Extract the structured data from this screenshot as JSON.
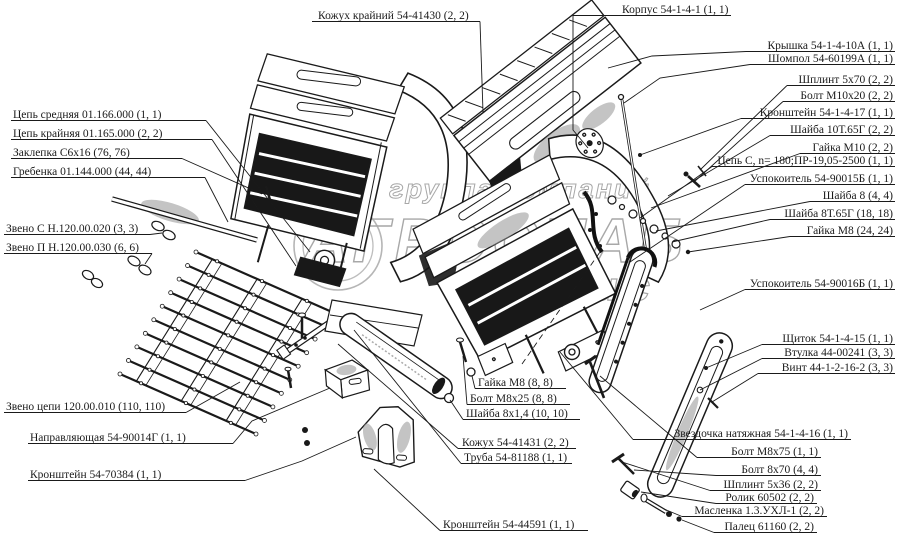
{
  "figure": {
    "background": "#ffffff",
    "ink": "#1a1a1a",
    "watermark_color": "#a8a8a8",
    "description": "Exploded parts diagram of elevator/conveyor assemblies with callout labels"
  },
  "watermark": {
    "line1": "группа компаний",
    "line2": "АГРОСНАБ",
    "line3": "сервис"
  },
  "labels": [
    {
      "name": "kozhuh-krayniy",
      "text": "Кожух крайний 54-41430 (2, 2)",
      "x": 318,
      "y": 19,
      "anchor": "start",
      "ul": [
        312,
        480
      ],
      "leader": [
        [
          480,
          21.5
        ],
        [
          483,
          112
        ]
      ]
    },
    {
      "name": "korpus",
      "text": "Корпус 54-1-4-1 (1, 1)",
      "x": 622,
      "y": 13,
      "anchor": "start",
      "ul": [
        617,
        731
      ],
      "leader": [
        [
          617,
          15.5
        ],
        [
          573,
          15.5
        ],
        [
          573,
          130
        ],
        [
          588,
          148
        ]
      ]
    },
    {
      "name": "kryshka",
      "text": "Крышка 54-1-4-10А (1, 1)",
      "x": 893,
      "y": 49,
      "anchor": "end",
      "ul": [
        746,
        895
      ],
      "leader": [
        [
          746,
          51.5
        ],
        [
          652,
          56
        ],
        [
          608,
          68
        ]
      ]
    },
    {
      "name": "shompol",
      "text": "Шомпол 54-60199А (1, 1)",
      "x": 893,
      "y": 62,
      "anchor": "end",
      "ul": [
        750,
        895
      ],
      "leader": [
        [
          750,
          64.5
        ],
        [
          660,
          78
        ],
        [
          624,
          103
        ]
      ]
    },
    {
      "name": "shplint-5x70",
      "text": "Шплинт 5х70 (2, 2)",
      "x": 893,
      "y": 83,
      "anchor": "end",
      "ul": [
        787,
        895
      ],
      "leader": [
        [
          787,
          85.5
        ],
        [
          700,
          170
        ]
      ]
    },
    {
      "name": "bolt-m10x20",
      "text": "Болт М10х20 (2, 2)",
      "x": 893,
      "y": 99,
      "anchor": "end",
      "ul": [
        783,
        895
      ],
      "leader": [
        [
          783,
          101.5
        ],
        [
          694,
          182
        ]
      ]
    },
    {
      "name": "kronshteyn-54-1-4-17",
      "text": "Кронштейн 54-1-4-17 (1, 1)",
      "x": 893,
      "y": 116,
      "anchor": "end",
      "ul": [
        741,
        895
      ],
      "leader": [
        [
          741,
          118.5
        ],
        [
          640,
          155
        ]
      ]
    },
    {
      "name": "shayba-10t65g",
      "text": "Шайба 10Т.65Г (2, 2)",
      "x": 893,
      "y": 133,
      "anchor": "end",
      "ul": [
        770,
        895
      ],
      "leader": [
        [
          770,
          135.5
        ],
        [
          668,
          196
        ]
      ]
    },
    {
      "name": "gayka-m10",
      "text": "Гайка М10 (2, 2)",
      "x": 893,
      "y": 151,
      "anchor": "end",
      "ul": [
        800,
        895
      ],
      "leader": [
        [
          800,
          153.5
        ],
        [
          651,
          208
        ]
      ]
    },
    {
      "name": "tsep-s",
      "text": "Цепь С, n= 180;ПР-19,05-2500 (1, 1)",
      "x": 893,
      "y": 164,
      "anchor": "end",
      "ul": [
        712,
        895
      ],
      "leader": [
        [
          712,
          166.5
        ],
        [
          640,
          218
        ]
      ]
    },
    {
      "name": "uspokoitel-90015b",
      "text": "Успокоитель 54-90015Б (1, 1)",
      "x": 893,
      "y": 182,
      "anchor": "end",
      "ul": [
        745,
        895
      ],
      "leader": [
        [
          745,
          184.5
        ],
        [
          630,
          262
        ]
      ]
    },
    {
      "name": "shayba-8",
      "text": "Шайба 8 (4, 4)",
      "x": 893,
      "y": 199,
      "anchor": "end",
      "ul": [
        810,
        895
      ],
      "leader": [
        [
          810,
          201.5
        ],
        [
          656,
          231
        ]
      ]
    },
    {
      "name": "shayba-8t65g",
      "text": "Шайба 8Т.65Г (18, 18)",
      "x": 893,
      "y": 217,
      "anchor": "end",
      "ul": [
        770,
        895
      ],
      "leader": [
        [
          770,
          219.5
        ],
        [
          672,
          242
        ]
      ]
    },
    {
      "name": "gayka-m8-24",
      "text": "Гайка М8 (24, 24)",
      "x": 893,
      "y": 234,
      "anchor": "end",
      "ul": [
        790,
        895
      ],
      "leader": [
        [
          790,
          236.5
        ],
        [
          688,
          252
        ]
      ]
    },
    {
      "name": "uspokoitel-90016b",
      "text": "Успокоитель 54-90016Б (1, 1)",
      "x": 893,
      "y": 287,
      "anchor": "end",
      "ul": [
        745,
        895
      ],
      "leader": [
        [
          745,
          289.5
        ],
        [
          700,
          310
        ]
      ]
    },
    {
      "name": "shchitok",
      "text": "Щиток 54-1-4-15 (1, 1)",
      "x": 893,
      "y": 342,
      "anchor": "end",
      "ul": [
        762,
        895
      ],
      "leader": [
        [
          762,
          344.5
        ],
        [
          706,
          368
        ]
      ]
    },
    {
      "name": "vtulka",
      "text": "Втулка 44-00241 (3, 3)",
      "x": 893,
      "y": 356,
      "anchor": "end",
      "ul": [
        762,
        895
      ],
      "leader": [
        [
          762,
          358.5
        ],
        [
          700,
          390
        ]
      ]
    },
    {
      "name": "vint",
      "text": "Винт 44-1-2-16-2 (3, 3)",
      "x": 893,
      "y": 371,
      "anchor": "end",
      "ul": [
        758,
        895
      ],
      "leader": [
        [
          758,
          373.5
        ],
        [
          712,
          402
        ]
      ]
    },
    {
      "name": "zvezdochka",
      "text": "Звездочка натяжная 54-1-4-16 (1, 1)",
      "x": 848,
      "y": 437,
      "anchor": "end",
      "ul": [
        633,
        851
      ],
      "leader": [
        [
          633,
          439.5
        ],
        [
          560,
          352
        ]
      ]
    },
    {
      "name": "bolt-m8x75",
      "text": "Болт М8х75 (1, 1)",
      "x": 818,
      "y": 455,
      "anchor": "end",
      "ul": [
        697,
        821
      ],
      "leader": [
        [
          697,
          457.5
        ],
        [
          600,
          376
        ]
      ]
    },
    {
      "name": "bolt-8x70",
      "text": "Болт 8х70 (4, 4)",
      "x": 818,
      "y": 473,
      "anchor": "end",
      "ul": [
        716,
        821
      ],
      "leader": [
        [
          716,
          475.5
        ],
        [
          634,
          470
        ]
      ]
    },
    {
      "name": "shplint-5x36",
      "text": "Шплинт 5х36 (2, 2)",
      "x": 818,
      "y": 488,
      "anchor": "end",
      "ul": [
        710,
        821
      ],
      "leader": [
        [
          710,
          490.5
        ],
        [
          622,
          462
        ]
      ]
    },
    {
      "name": "rolik",
      "text": "Ролик 60502 (2, 2)",
      "x": 814,
      "y": 501,
      "anchor": "end",
      "ul": [
        716,
        817
      ],
      "leader": [
        [
          716,
          503.5
        ],
        [
          641,
          492
        ]
      ]
    },
    {
      "name": "maslenka",
      "text": "Масленка 1.3.УХЛ-1 (2, 2)",
      "x": 824,
      "y": 514,
      "anchor": "end",
      "ul": [
        682,
        827
      ],
      "leader": [
        [
          682,
          516.5
        ],
        [
          664,
          509
        ]
      ]
    },
    {
      "name": "palets",
      "text": "Палец 61160 (2, 2)",
      "x": 814,
      "y": 530,
      "anchor": "end",
      "ul": [
        714,
        817
      ],
      "leader": [
        [
          714,
          532.5
        ],
        [
          682,
          520
        ]
      ]
    },
    {
      "name": "tsep-srednyaya",
      "text": "Цепь средняя 01.166.000 (1, 1)",
      "x": 13,
      "y": 118,
      "anchor": "start",
      "ul": [
        11,
        206
      ],
      "leader": [
        [
          206,
          120.5
        ],
        [
          310,
          252
        ]
      ]
    },
    {
      "name": "tsep-kraynyaya",
      "text": "Цепь крайняя 01.165.000 (2, 2)",
      "x": 13,
      "y": 137,
      "anchor": "start",
      "ul": [
        11,
        212
      ],
      "leader": [
        [
          212,
          139.5
        ],
        [
          296,
          266
        ]
      ]
    },
    {
      "name": "zaklepka",
      "text": "Заклепка С6х16 (76, 76)",
      "x": 13,
      "y": 156,
      "anchor": "start",
      "ul": [
        11,
        182
      ],
      "leader": [
        [
          182,
          158.5
        ],
        [
          262,
          194
        ]
      ]
    },
    {
      "name": "grebenka",
      "text": "Гребенка 01.144.000 (44, 44)",
      "x": 13,
      "y": 175,
      "anchor": "start",
      "ul": [
        11,
        205
      ],
      "leader": [
        [
          205,
          177.5
        ],
        [
          228,
          222
        ]
      ]
    },
    {
      "name": "zveno-s",
      "text": "Звено С Н.120.00.020 (3, 3)",
      "x": 6,
      "y": 232,
      "anchor": "start",
      "ul": [
        4,
        150
      ],
      "leader": [
        [
          150,
          234.5
        ],
        [
          162,
          233
        ]
      ]
    },
    {
      "name": "zveno-p",
      "text": "Звено П Н.120.00.030 (6, 6)",
      "x": 6,
      "y": 251,
      "anchor": "start",
      "ul": [
        4,
        152
      ],
      "leader": [
        [
          152,
          253.5
        ],
        [
          145,
          264
        ]
      ]
    },
    {
      "name": "zveno-tsepi",
      "text": "Звено цепи 120.00.010 (110, 110)",
      "x": 6,
      "y": 410,
      "anchor": "start",
      "ul": [
        4,
        186
      ],
      "leader": [
        [
          186,
          412.5
        ],
        [
          240,
          382
        ]
      ]
    },
    {
      "name": "napravlyayushchaya",
      "text": "Направляющая 54-90014Г (1, 1)",
      "x": 30,
      "y": 441,
      "anchor": "start",
      "ul": [
        28,
        233
      ],
      "leader": [
        [
          233,
          443.5
        ],
        [
          252,
          421
        ],
        [
          330,
          388
        ]
      ]
    },
    {
      "name": "kronshteyn-70384",
      "text": "Кронштейн 54-70384 (1, 1)",
      "x": 30,
      "y": 478,
      "anchor": "start",
      "ul": [
        28,
        245
      ],
      "leader": [
        [
          245,
          480.5
        ],
        [
          302,
          461
        ],
        [
          356,
          437
        ]
      ]
    },
    {
      "name": "gayka-m8-8",
      "text": "Гайка М8 (8, 8)",
      "x": 478,
      "y": 386,
      "anchor": "start",
      "ul": [
        475,
        566
      ],
      "leader": [
        [
          475,
          388.5
        ],
        [
          472,
          376
        ]
      ]
    },
    {
      "name": "bolt-m8x25",
      "text": "Болт М8х25 (8, 8)",
      "x": 470,
      "y": 402,
      "anchor": "start",
      "ul": [
        467,
        570
      ],
      "leader": [
        [
          467,
          404.5
        ],
        [
          463,
          356
        ]
      ]
    },
    {
      "name": "shayba-8x14",
      "text": "Шайба 8х1,4 (10, 10)",
      "x": 466,
      "y": 417,
      "anchor": "start",
      "ul": [
        463,
        580
      ],
      "leader": [
        [
          463,
          419.5
        ],
        [
          450,
          400
        ]
      ]
    },
    {
      "name": "kozhuh-41431",
      "text": "Кожух 54-41431 (2, 2)",
      "x": 462,
      "y": 446,
      "anchor": "start",
      "ul": [
        458,
        576
      ],
      "leader": [
        [
          458,
          448.5
        ],
        [
          338,
          344
        ]
      ]
    },
    {
      "name": "truba",
      "text": "Труба 54-81188 (1, 1)",
      "x": 464,
      "y": 461,
      "anchor": "start",
      "ul": [
        461,
        572
      ],
      "leader": [
        [
          461,
          463.5
        ],
        [
          354,
          330
        ]
      ]
    },
    {
      "name": "kronshteyn-44591",
      "text": "Кронштейн 54-44591 (1, 1)",
      "x": 443,
      "y": 528,
      "anchor": "start",
      "ul": [
        440,
        588
      ],
      "leader": [
        [
          440,
          530.5
        ],
        [
          374,
          469
        ]
      ]
    }
  ]
}
